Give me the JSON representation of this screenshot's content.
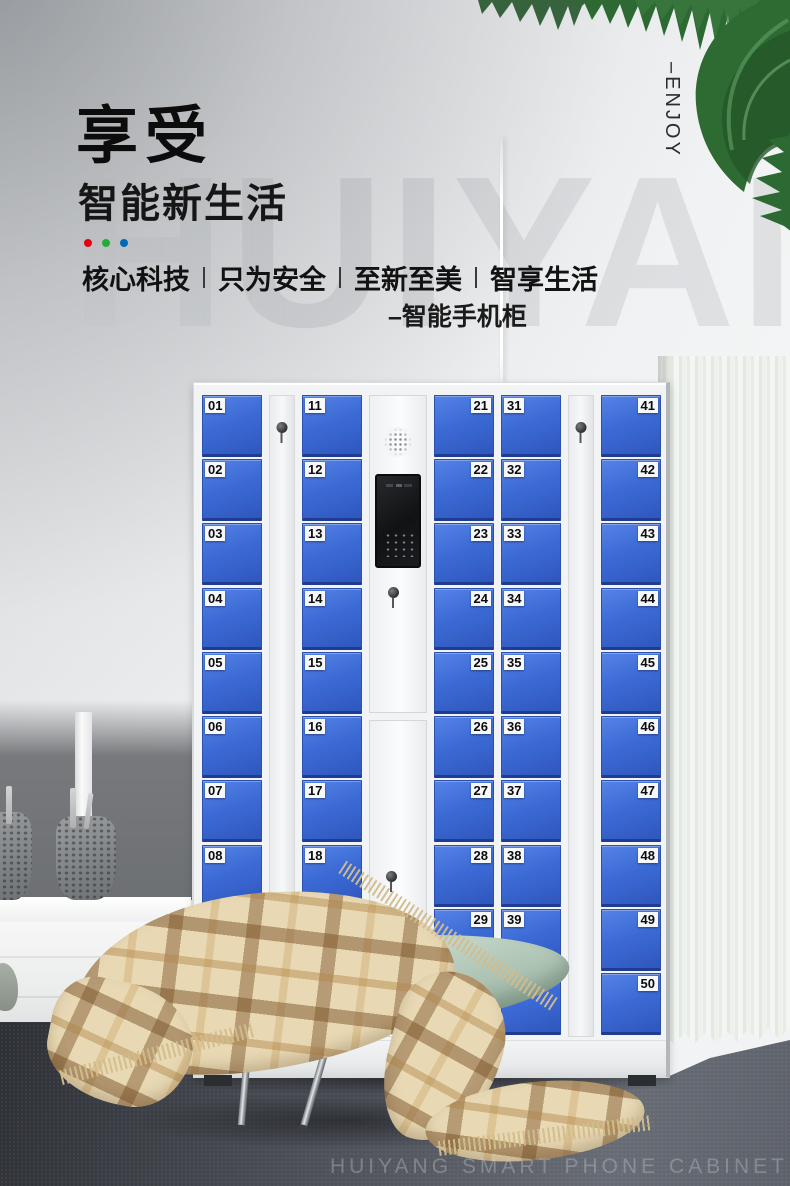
{
  "page": {
    "title_main": "享受",
    "title_sub": "智能新生活",
    "tagline": {
      "phrases": [
        "核心科技",
        "只为安全",
        "至新至美",
        "智享生活"
      ]
    },
    "product_label": "–智能手机柜",
    "vertical_label": "–ENJOY",
    "watermark": "HUIYAN",
    "footer_caption": "HUIYANG SMART PHONE CABINET"
  },
  "accent_dots": [
    "#e60012",
    "#22ac38",
    "#0068b7"
  ],
  "colors": {
    "door_blue": "#3c6bd6",
    "door_blue_dark": "#1e3d92",
    "cabinet_white": "#f2f3f5",
    "leaf_green": "#2e6b33",
    "floor_dark": "#43464d",
    "curtain_white": "#eef1ec",
    "blanket_beige": "#e8d9b4"
  },
  "cabinet": {
    "columns": [
      {
        "kind": "doors",
        "name": "door-column-1",
        "label_side": "left",
        "doors": [
          "01",
          "02",
          "03",
          "04",
          "05",
          "06",
          "07",
          "08",
          "09",
          "10"
        ]
      },
      {
        "kind": "lock",
        "name": "lock-strip-1"
      },
      {
        "kind": "doors",
        "name": "door-column-2",
        "label_side": "left",
        "doors": [
          "11",
          "12",
          "13",
          "14",
          "15",
          "16",
          "17",
          "18",
          "19",
          "20"
        ]
      },
      {
        "kind": "panel",
        "name": "control-panel-column"
      },
      {
        "kind": "doors",
        "name": "door-column-3",
        "label_side": "right",
        "doors": [
          "21",
          "22",
          "23",
          "24",
          "25",
          "26",
          "27",
          "28",
          "29",
          "30"
        ]
      },
      {
        "kind": "doors",
        "name": "door-column-4",
        "label_side": "left",
        "doors": [
          "31",
          "32",
          "33",
          "34",
          "35",
          "36",
          "37",
          "38",
          "39",
          "40"
        ]
      },
      {
        "kind": "lock",
        "name": "lock-strip-2"
      },
      {
        "kind": "doors",
        "name": "door-column-5",
        "label_side": "right",
        "doors": [
          "41",
          "42",
          "43",
          "44",
          "45",
          "46",
          "47",
          "48",
          "49",
          "50"
        ]
      }
    ]
  }
}
